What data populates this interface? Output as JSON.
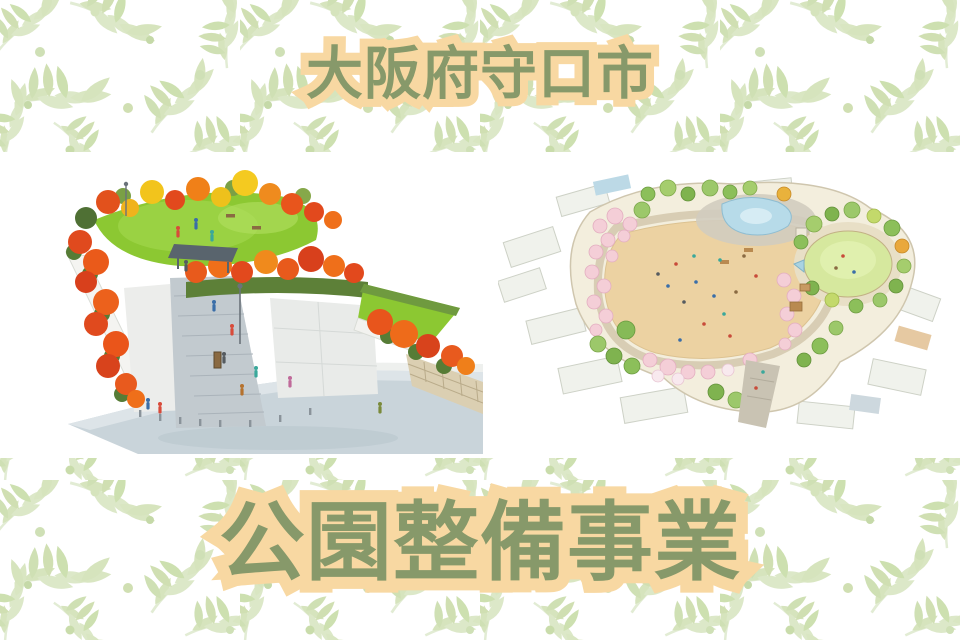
{
  "banner": {
    "top_title": "大阪府守口市",
    "bottom_title": "公園整備事業",
    "colors": {
      "title_green": "#87996a",
      "title_highlight_peach": "#f8d8a2",
      "leaf_pattern_green": "#d8e3c8",
      "illustration_band_background": "#ffffff",
      "autumn_tree_red": "#e2491d",
      "autumn_tree_orange": "#f08018",
      "autumn_tree_yellow": "#f2c41c",
      "lawn_green": "#8cc832",
      "field_tan": "#ecd2a2",
      "pond_blue": "#b7dbe9",
      "cherry_pink": "#f4ced7"
    },
    "illustrations": [
      {
        "name": "autumn-park-perspective-rendering"
      },
      {
        "name": "park-aerial-plan-rendering"
      }
    ]
  }
}
